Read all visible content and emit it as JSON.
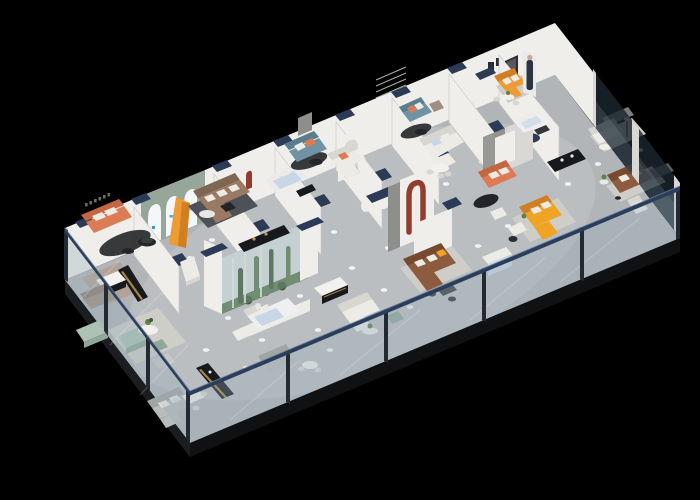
{
  "scene": {
    "type": "isometric-3d-floorplan-render",
    "subject": "furniture showroom cutaway dollhouse view",
    "background": "#000000",
    "view": "top-down isometric from south-east",
    "perimeter": "glass balustrade walls with navy top rail on the two front edges; white walls with navy end caps inside",
    "notable_zones": [
      "coral sofa lounge with black oval rug (top-left)",
      "sage-green wall with three white arched windows and orange display panel",
      "brown fabric sectional on dark rug",
      "light-blue bed room",
      "two teal sofas with orange cushions along back corridor",
      "indoor glass terrarium planter with cacti (center-left)",
      "white bed with curved white partition (center)",
      "red J-shaped arch feature wall (center)",
      "brown leather sectional with dining set and red wall logo",
      "yellow-orange sectional sofa (center-right)",
      "reception room at top corner with orange sofa and promo standee of a woman",
      "right wing behind dark glass partitions: white sofa, brown sofa, white armchair",
      "sage green lounge, gray sectionals and dining sets (bottom-left)",
      "black display counters with gold trim stripes",
      "ceiling spotlight glows across the gray floor"
    ]
  },
  "palette": {
    "background": "#000000",
    "floor": "#b2b5b8",
    "floorGlow": "#c6c9cb",
    "slabEdge": "#1b1d20",
    "slabEdge2": "#101113",
    "wallLit": "#efeeea",
    "wallShade": "#d9d8d4",
    "wallDark": "#8e8e8b",
    "navyCap": "#2b3a55",
    "glassTint": "rgba(150,172,184,0.34)",
    "glassDark": "rgba(28,38,46,0.82)",
    "glassFrame": "#232a33",
    "railNavy": "#2c3d59",
    "sofaCoral": "#dd7b55",
    "sofaCoralDark": "#c4663f",
    "sofaOrange": "#ee9a35",
    "sofaOrangeDark": "#d07f22",
    "sofaYellow": "#f0a426",
    "sofaTeal": "#6f93a2",
    "sofaTealDark": "#597e8d",
    "sofaSage": "#adc2b4",
    "sofaSageDark": "#90a899",
    "sofaBrown": "#9b7a64",
    "sofaBrownDark": "#7f6652",
    "sofaLeather": "#8d5b3e",
    "sofaLeatherDark": "#774a30",
    "sofaTaupe": "#a28e80",
    "sofaTaupeDark": "#8f7c6e",
    "sofaWhite": "#ecebe6",
    "sofaWhiteShade": "#d7d6d0",
    "sofaGray": "#b9bcbc",
    "sofaGrayDark": "#a2a5a5",
    "rugDark": "#4e5258",
    "rugLight": "#cfcdc7",
    "rugTaupe": "#b3a396",
    "counterDark": "#17191d",
    "counterGold": "#c09a4a",
    "archRed": "#943b30",
    "archWallSage": "#97a69b",
    "archWhite": "#f4f6f7",
    "logoBlue": "#2f9fc6",
    "bedBlue": "#c8d6e6",
    "plantGreen": "#5d7f4c",
    "plantDark": "#3f5c36",
    "terrariumBack": "#dde2e0",
    "terrariumGround": "#5e7c4e",
    "spotlight": "#ffffff",
    "figureDark": "#2d3440",
    "figureSkin": "#c9a68f",
    "posterDark": "#2b2d33",
    "posterInner": "#56585e",
    "tableBlack": "#232528"
  },
  "elements": [
    {
      "name": "floor-slab",
      "color": "floor"
    },
    {
      "name": "glass-perimeter-railing",
      "color": "railNavy"
    },
    {
      "name": "back-wall",
      "color": "wallLit"
    },
    {
      "name": "arched-display-wall",
      "color": "archWallSage",
      "arches": 3
    },
    {
      "name": "coral-sofa-lounge",
      "color": "sofaCoral"
    },
    {
      "name": "brown-fabric-sectional",
      "color": "sofaBrown"
    },
    {
      "name": "orange-display-panel",
      "color": "sofaOrange"
    },
    {
      "name": "light-blue-bed",
      "color": "bedBlue"
    },
    {
      "name": "teal-sofas",
      "color": "sofaTeal",
      "count": 2
    },
    {
      "name": "white-corner-sofa",
      "color": "sofaWhite"
    },
    {
      "name": "indoor-terrarium",
      "color": "terrariumGround"
    },
    {
      "name": "red-arch-feature",
      "color": "archRed"
    },
    {
      "name": "yellow-sectional-sofa",
      "color": "sofaYellow"
    },
    {
      "name": "brown-leather-sectional",
      "color": "sofaLeather"
    },
    {
      "name": "coral-sofa-center",
      "color": "sofaCoral"
    },
    {
      "name": "sage-green-lounge",
      "color": "sofaSage"
    },
    {
      "name": "gray-sectional",
      "color": "sofaGray"
    },
    {
      "name": "white-bed",
      "color": "sofaWhite"
    },
    {
      "name": "reception-orange-sofa",
      "color": "sofaOrange"
    },
    {
      "name": "promo-standee-figure",
      "color": "figureDark"
    },
    {
      "name": "display-counters",
      "color": "counterDark",
      "count": 4
    },
    {
      "name": "dining-sets",
      "count": 7
    },
    {
      "name": "glass-partitions-dark",
      "color": "glassDark",
      "count": 2
    },
    {
      "name": "ceiling-spotlight-glows",
      "color": "spotlight",
      "count": 33
    }
  ]
}
